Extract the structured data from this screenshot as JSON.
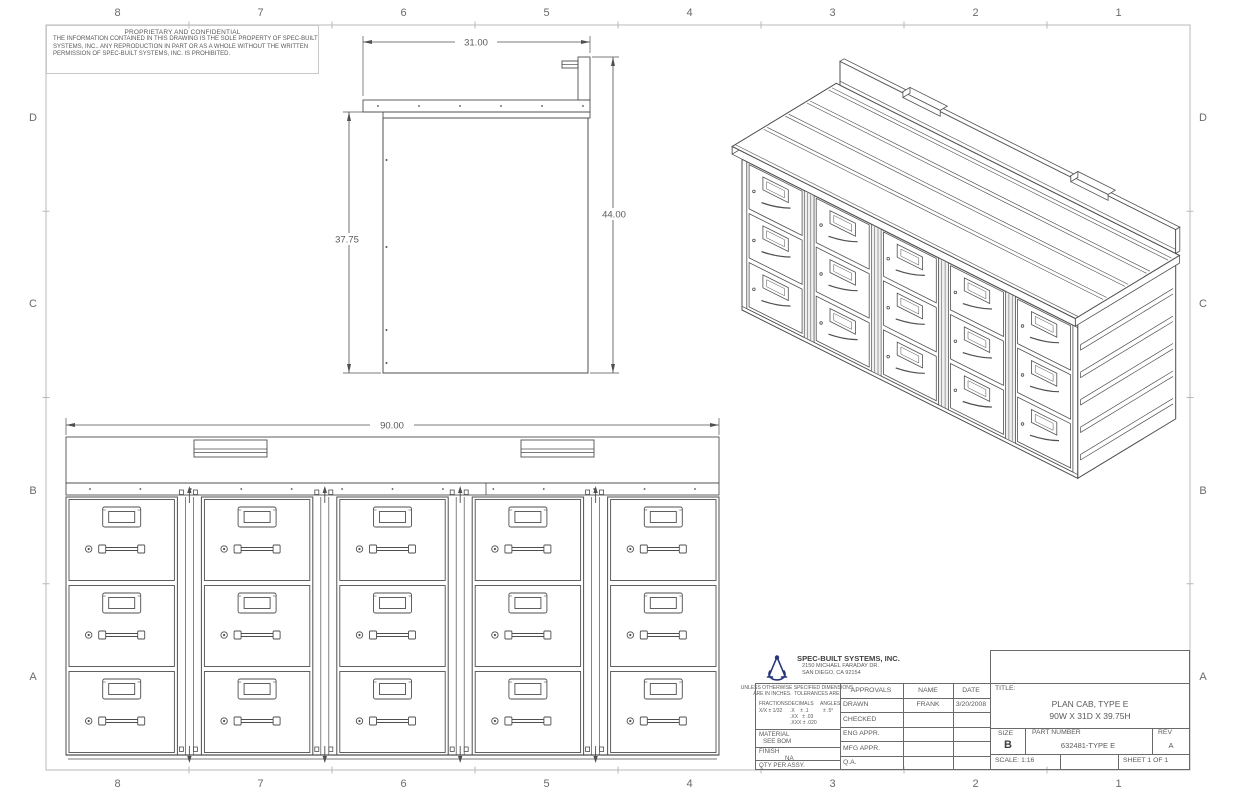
{
  "sheet": {
    "background": "#ffffff",
    "line_color": "#4f4f4f",
    "border_color": "#b8b8b8",
    "text_color": "#5a5a5a",
    "zone_columns": [
      "8",
      "7",
      "6",
      "5",
      "4",
      "3",
      "2",
      "1"
    ],
    "zone_rows": [
      "D",
      "C",
      "B",
      "A"
    ]
  },
  "proprietary_notice": {
    "heading": "PROPRIETARY AND CONFIDENTIAL",
    "lines": [
      "THE INFORMATION CONTAINED IN THIS DRAWING IS THE SOLE PROPERTY OF SPEC-BUILT",
      "SYSTEMS, INC..  ANY REPRODUCTION IN PART OR AS A WHOLE WITHOUT THE WRITTEN",
      "PERMISSION OF SPEC-BUILT SYSTEMS, INC. IS PROHIBITED."
    ]
  },
  "views": {
    "side_view": {
      "dims": {
        "top_width": "31.00",
        "body_height": "37.75",
        "total_height": "44.00"
      }
    },
    "front_view": {
      "dims": {
        "overall_width": "90.00"
      },
      "columns": 5,
      "drawer_rows": 3
    },
    "isometric_view": {
      "columns": 5,
      "drawer_rows": 3,
      "top_handles": 2,
      "side_slats": 5
    }
  },
  "title_block": {
    "company": {
      "name": "SPEC-BUILT SYSTEMS, INC.",
      "address_line1": "2150 MICHAEL FARADAY DR.",
      "address_line2": "SAN DIEGO, CA 92154",
      "logo": "compass-icon",
      "logo_color": "#26357a"
    },
    "title_label": "TITLE:",
    "title_line1": "PLAN CAB, TYPE E",
    "title_line2": "90W X 31D X 39.75H",
    "size_label": "SIZE",
    "size_value": "B",
    "part_number_label": "PART NUMBER",
    "part_number_value": "632481-TYPE E",
    "rev_label": "REV",
    "rev_value": "A",
    "scale_text": "SCALE: 1:16",
    "sheet_text": "SHEET 1 OF 1",
    "general_note_line1": "UNLESS OTHERWISE SPECIFIED DIMENSIONS",
    "general_note_line2": "ARE IN INCHES.  TOLERANCES ARE:",
    "fractions_label": "FRACTIONS",
    "fractions_value": "X/X ± 1/32",
    "decimals_label": "DECIMALS",
    "decimals_values": [
      ".X    ± .1",
      ".XX   ± .03",
      ".XXX ± .020"
    ],
    "angles_label": "ANGLES",
    "angles_value": "± .5°",
    "material_label": "MATERIAL",
    "material_value": "SEE BOM",
    "finish_label": "FINISH",
    "finish_value": "NA",
    "qty_label": "QTY PER ASSY.",
    "approvals_headers": [
      "APPROVALS",
      "NAME",
      "DATE"
    ],
    "approvals_rows": [
      {
        "label": "DRAWN",
        "name": "FRANK",
        "date": "3/20/2008"
      },
      {
        "label": "CHECKED",
        "name": "",
        "date": ""
      },
      {
        "label": "ENG APPR.",
        "name": "",
        "date": ""
      },
      {
        "label": "MFG APPR.",
        "name": "",
        "date": ""
      },
      {
        "label": "Q.A.",
        "name": "",
        "date": ""
      }
    ]
  }
}
